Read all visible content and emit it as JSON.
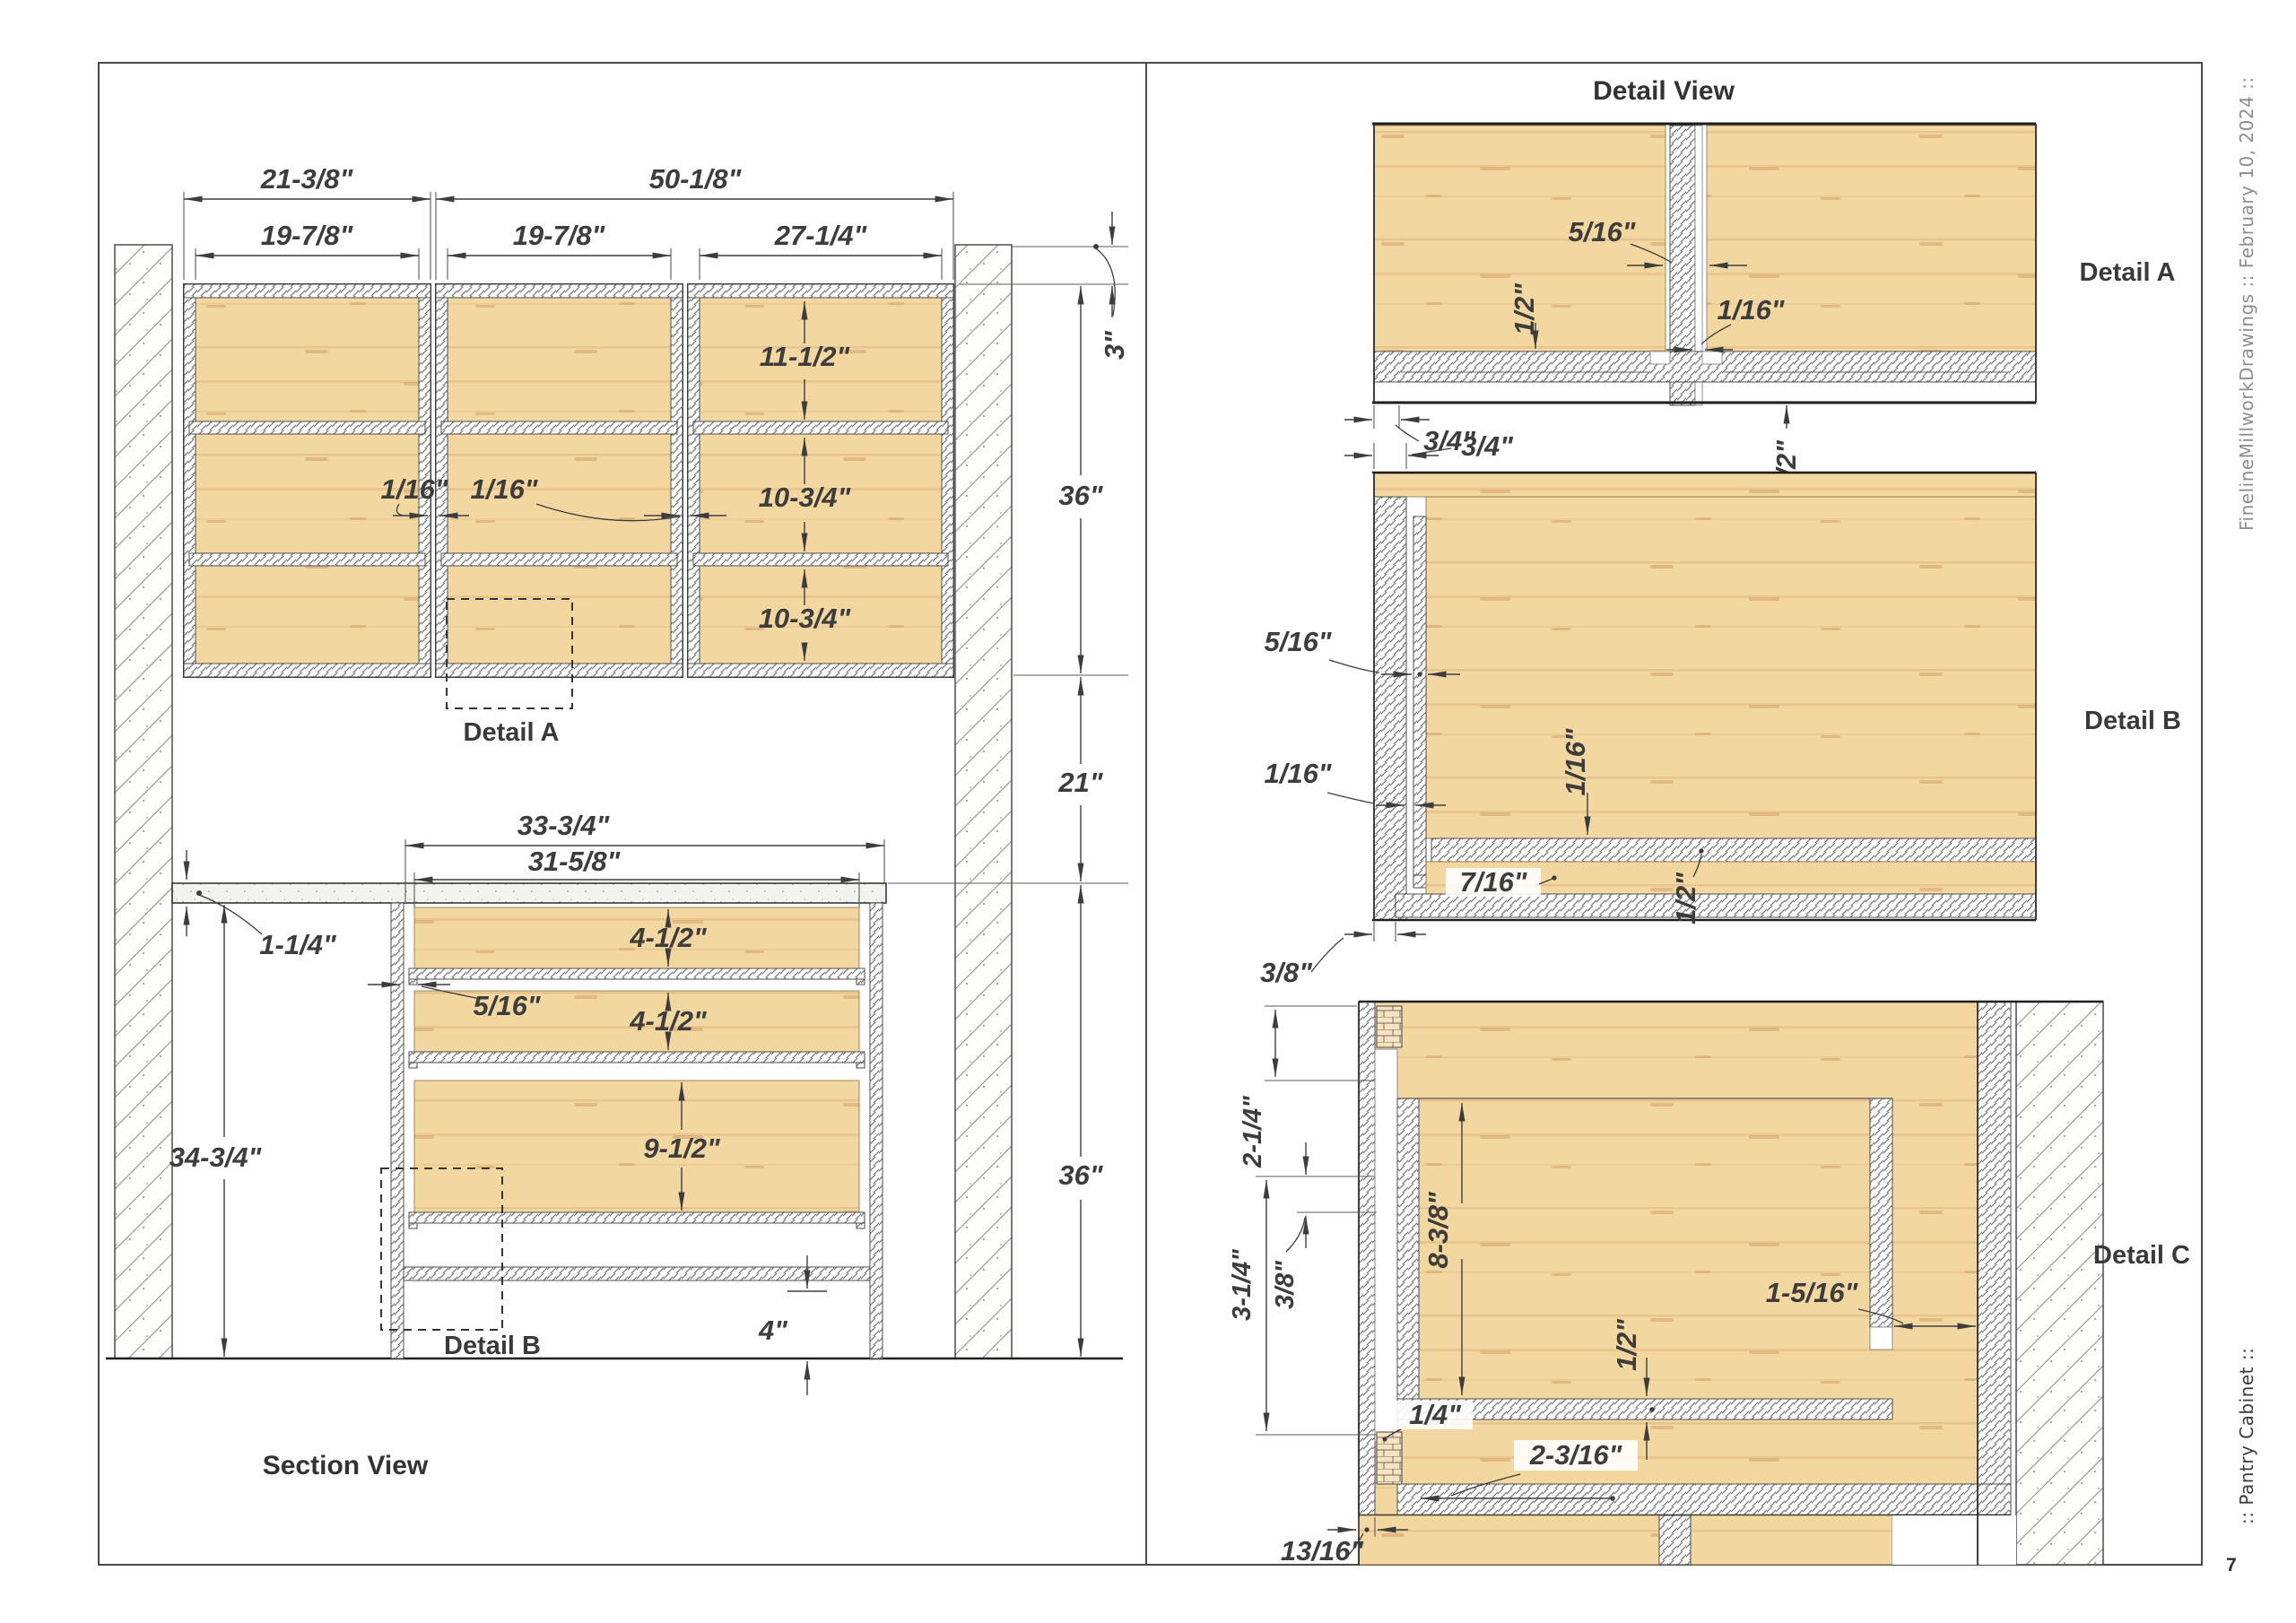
{
  "margin": {
    "credit": "FinelineMillworkDrawings ::  February 10, 2024  ::",
    "project": ":: Pantry Cabinet  ::",
    "page": "7"
  },
  "section_view": {
    "title": "Section View",
    "detail_a_tag": "Detail A",
    "detail_b_tag": "Detail B",
    "dims": {
      "w_left": "21-3/8\"",
      "w_right": "50-1/8\"",
      "w_box1": "19-7/8\"",
      "w_box2": "19-7/8\"",
      "w_box3": "27-1/4\"",
      "soffit": "3\"",
      "upper_h": "36\"",
      "gap_h": "21\"",
      "base_h": "36\"",
      "shelf1": "11-1/2\"",
      "shelf2": "10-3/4\"",
      "shelf3": "10-3/4\"",
      "gap1": "1/16\"",
      "gap2": "1/16\"",
      "counter_depth": "33-3/4\"",
      "drawer_w": "31-5/8\"",
      "counter_t": "1-1/4\"",
      "counter_h": "34-3/4\"",
      "drawer1": "4-1/2\"",
      "drawer2": "4-1/2\"",
      "drawer_gap": "5/16\"",
      "drawer3": "9-1/2\"",
      "toe": "4\""
    }
  },
  "detail_view": {
    "title": "Detail View",
    "a": {
      "caption": "Detail A",
      "divider_t": "5/16\"",
      "dado": "1/2\"",
      "gap": "1/16\"",
      "panel": "3/4\"",
      "rail": "1/2\""
    },
    "b": {
      "caption": "Detail B",
      "panel": "3/4\"",
      "inner": "5/16\"",
      "gap_left": "1/16\"",
      "gap_mid": "1/16\"",
      "strip": "7/16\"",
      "shelf": "1/2\"",
      "step": "3/8\""
    },
    "c": {
      "caption": "Detail C",
      "top": "2-1/4\"",
      "side": "3-1/4\"",
      "offset": "3/8\"",
      "interior": "8-3/8\"",
      "shelf": "1/2\"",
      "clear": "1-5/16\"",
      "slide": "1/4\"",
      "depth": "2-3/16\"",
      "face": "13/16\""
    }
  }
}
